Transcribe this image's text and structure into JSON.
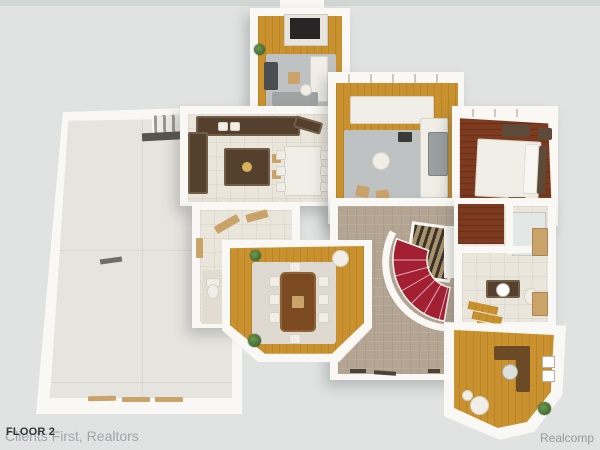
{
  "image": {
    "kind": "3d-floorplan-render",
    "floor_shown": "2"
  },
  "watermarks": {
    "floor_label": "FLOOR 2",
    "listing_brand": "Clients First, Realtors",
    "mls_brand": "Realcomp"
  },
  "palette": {
    "bg": "#e0e3e2",
    "bgtop": "#d2d6d5",
    "wall": "#f9f8f4",
    "wood": "#c9922f",
    "wooddark": "#7d3a1e",
    "tablewood": "#7c4a20",
    "tile": "#eae6db",
    "carpet": "#b4a593",
    "rug": "#bfc2c2",
    "ruglight": "#dedad1",
    "counter": "#54402c",
    "stairred": "#a32033",
    "garage": "#e6e4df",
    "green": "#3f6b33",
    "grayfurn": "#9aa0a1",
    "textdark": "#323537",
    "textgray": "#a2a6a9"
  },
  "rooms": [
    "garage",
    "hearth room",
    "kitchen",
    "breakfast nook",
    "living room",
    "bedroom",
    "great room",
    "dining room",
    "home office",
    "bathroom",
    "powder room",
    "mudroom hallway",
    "curved staircase",
    "garage staircase"
  ]
}
